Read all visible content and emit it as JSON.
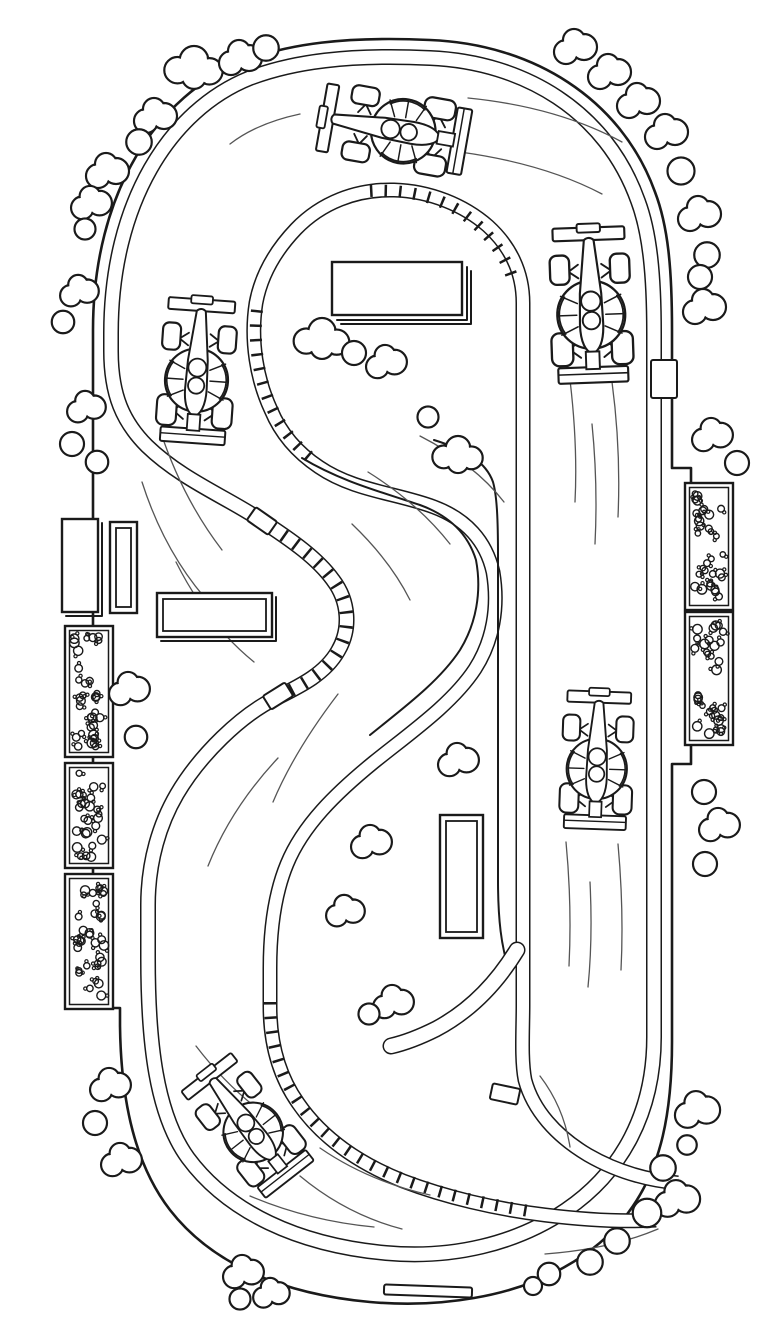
{
  "scene": {
    "kind": "coloring-page line-art illustration",
    "subject": "top-down race track with formula cars",
    "background": "#ffffff",
    "ink": "#1a1a1a",
    "speedline_color": "#555555",
    "width": 768,
    "height": 1344
  },
  "track": {
    "outer_wall": "M 430,40 C 532,44 621,98 655,192 C 668,226 672,268 672,330 L 672,468 L 691,468 L 691,764 L 672,764 L 672,1042 C 672,1110 662,1168 628,1213 C 596,1256 540,1287 474,1298 C 440,1304 404,1305 370,1302 C 282,1294 212,1264 170,1210 C 136,1166 121,1104 120,1026 L 120,1008 L 93,1008 L 93,330 C 93,192 158,94 244,61 C 288,44 345,36 430,40 Z",
    "wall_band": "M 430,58 C 524,62 606,111 638,201 C 650,233 654,276 654,333 L 654,1037 C 654,1112 622,1172 566,1210 C 516,1244 452,1259 386,1253 C 298,1245 228,1212 188,1158 C 156,1114 148,1042 148,958 L 148,905 C 148,861 160,823 177,794 C 200,755 241,715 276,698 C 300,686 325,674 338,651 C 351,629 349,601 333,580 C 318,559 293,541 259,519 C 226,497 181,479 147,446 C 123,422 111,395 111,351 L 111,333 C 111,203 170,110 250,78 C 292,62 348,54 430,58 Z",
    "wall_hairpin_hatch": "M 259,519 C 293,541 318,559 333,580 C 349,601 351,629 338,651 C 325,674 300,686 276,698",
    "island_band": "M 678,1183 C 645,1180 614,1170 588,1155 C 556,1136 533,1110 525,1080 C 521,1060 523,1030 523,1005 L 523,303 C 523,272 510,246 488,226 C 464,205 430,191 394,190 C 356,189 321,203 296,229 C 275,251 261,276 256,303 C 250,341 257,380 271,410 C 281,434 298,453 319,467 C 354,491 397,493 434,507 C 466,519 486,541 493,572 C 499,607 493,641 475,669 C 452,704 410,733 374,762 C 336,793 303,825 287,864 C 275,893 270,929 270,968 L 270,1006 C 270,1043 279,1076 298,1103 C 322,1138 358,1163 403,1181 C 445,1197 495,1209 545,1215 C 586,1220 625,1222 656,1220",
    "island_hatches": [
      "M 370,191 C 404,189 438,196 464,214 C 489,232 507,256 514,284",
      "M 257,310 C 253,344 259,380 272,408 C 282,430 297,448 316,462",
      "M 270,1002 C 270,1042 280,1076 299,1103 C 323,1137 359,1162 403,1179 C 441,1194 486,1204 529,1211"
    ],
    "detail_lines": [
      "M 302,458 C 342,482 382,492 420,505 C 450,516 468,534 476,560 C 482,592 476,624 460,650 C 439,682 402,709 370,735",
      "M 434,440 C 466,450 486,462 493,482 C 497,496 498,520 498,556 L 498,880 C 498,918 501,948 510,972"
    ],
    "pit_ramp": "M 517,950 C 495,986 468,1012 436,1029 C 420,1037 404,1043 391,1046",
    "markers": [
      {
        "x": 262,
        "y": 521,
        "w": 26,
        "h": 16,
        "rot": 35
      },
      {
        "x": 278,
        "y": 696,
        "w": 26,
        "h": 16,
        "rot": -32
      },
      {
        "x": 505,
        "y": 1094,
        "w": 28,
        "h": 16,
        "rot": 12
      },
      {
        "x": 664,
        "y": 379,
        "w": 26,
        "h": 38,
        "rot": 0
      },
      {
        "x": 428,
        "y": 1291,
        "w": 88,
        "h": 10,
        "rot": 2
      }
    ]
  },
  "buildings": [
    {
      "name": "left-building-solid",
      "x": 62,
      "y": 519,
      "w": 36,
      "h": 93,
      "style": "solid3d"
    },
    {
      "name": "left-building-outline",
      "x": 110,
      "y": 522,
      "w": 27,
      "h": 91,
      "style": "inner"
    },
    {
      "name": "infield-building-wide",
      "x": 157,
      "y": 593,
      "w": 115,
      "h": 44,
      "style": "inner3d"
    },
    {
      "name": "top-building",
      "x": 332,
      "y": 262,
      "w": 130,
      "h": 53,
      "style": "shadow"
    },
    {
      "name": "infield-building-small",
      "x": 440,
      "y": 815,
      "w": 43,
      "h": 123,
      "style": "inner"
    }
  ],
  "grandstands": [
    {
      "name": "left-grandstand",
      "x": 65,
      "w": 48,
      "sections": [
        [
          626,
          757
        ],
        [
          763,
          868
        ],
        [
          874,
          1009
        ]
      ],
      "seed": 7
    },
    {
      "name": "right-grandstand",
      "x": 685,
      "w": 48,
      "sections": [
        [
          483,
          610
        ],
        [
          612,
          745
        ]
      ],
      "seed": 13
    }
  ],
  "cars": [
    {
      "name": "car-top",
      "x": 396,
      "y": 130,
      "rot": -80,
      "s": 0.92
    },
    {
      "name": "car-left",
      "x": 197,
      "y": 373,
      "rot": 4,
      "s": 0.9
    },
    {
      "name": "car-right-upper",
      "x": 591,
      "y": 307,
      "rot": -2,
      "s": 0.97
    },
    {
      "name": "car-right-lower",
      "x": 597,
      "y": 762,
      "rot": 2,
      "s": 0.86
    },
    {
      "name": "car-bottom",
      "x": 249,
      "y": 1127,
      "rot": -38,
      "s": 0.85
    }
  ],
  "clouds": [
    [
      194,
      68,
      1.1,
      3
    ],
    [
      240,
      59,
      1.0,
      2
    ],
    [
      266,
      48,
      0.85,
      1
    ],
    [
      155,
      117,
      1.0,
      2
    ],
    [
      139,
      142,
      0.85,
      1
    ],
    [
      107,
      172,
      1.0,
      2
    ],
    [
      91,
      204,
      0.95,
      2
    ],
    [
      85,
      229,
      0.7,
      1
    ],
    [
      79,
      292,
      0.9,
      2
    ],
    [
      63,
      322,
      0.75,
      1
    ],
    [
      86,
      408,
      0.9,
      2
    ],
    [
      72,
      444,
      0.8,
      1
    ],
    [
      97,
      462,
      0.75,
      1
    ],
    [
      129,
      690,
      0.95,
      2
    ],
    [
      136,
      737,
      0.75,
      1
    ],
    [
      110,
      1086,
      0.95,
      2
    ],
    [
      95,
      1123,
      0.8,
      1
    ],
    [
      121,
      1161,
      0.95,
      2
    ],
    [
      243,
      1273,
      0.95,
      2
    ],
    [
      271,
      1294,
      0.85,
      2
    ],
    [
      240,
      1299,
      0.7,
      1
    ],
    [
      697,
      1111,
      1.05,
      2
    ],
    [
      687,
      1145,
      0.65,
      1
    ],
    [
      663,
      1168,
      0.85,
      1
    ],
    [
      677,
      1200,
      1.05,
      2
    ],
    [
      647,
      1213,
      0.95,
      1
    ],
    [
      617,
      1241,
      0.85,
      1
    ],
    [
      590,
      1262,
      0.85,
      1
    ],
    [
      549,
      1274,
      0.75,
      1
    ],
    [
      533,
      1286,
      0.6,
      1
    ],
    [
      575,
      48,
      1.0,
      2
    ],
    [
      609,
      73,
      1.0,
      2
    ],
    [
      638,
      102,
      1.0,
      2
    ],
    [
      666,
      133,
      1.0,
      2
    ],
    [
      681,
      171,
      0.9,
      1
    ],
    [
      699,
      215,
      1.0,
      2
    ],
    [
      707,
      255,
      0.85,
      1
    ],
    [
      700,
      277,
      0.8,
      1
    ],
    [
      704,
      308,
      1.0,
      2
    ],
    [
      712,
      436,
      0.95,
      2
    ],
    [
      737,
      463,
      0.8,
      1
    ],
    [
      704,
      792,
      0.8,
      1
    ],
    [
      719,
      826,
      0.95,
      2
    ],
    [
      705,
      864,
      0.8,
      1
    ],
    [
      322,
      339,
      1.05,
      3
    ],
    [
      354,
      353,
      0.8,
      1
    ],
    [
      386,
      363,
      0.95,
      2
    ],
    [
      428,
      417,
      0.7,
      1
    ],
    [
      458,
      455,
      0.95,
      3
    ],
    [
      458,
      761,
      0.95,
      2
    ],
    [
      371,
      843,
      0.95,
      2
    ],
    [
      345,
      912,
      0.9,
      2
    ],
    [
      393,
      1003,
      0.95,
      2
    ],
    [
      369,
      1014,
      0.7,
      1
    ]
  ],
  "speed_lines": [
    "M 468,98 C 528,104 578,118 622,142",
    "M 460,152 C 518,160 564,174 602,194",
    "M 300,114 C 272,120 248,130 230,144",
    "M 570,380 C 575,422 577,462 575,502",
    "M 612,382 C 618,427 620,472 618,517",
    "M 592,424 C 596,464 597,504 595,544",
    "M 566,842 C 570,884 571,926 569,966",
    "M 618,844 C 622,888 623,930 621,970",
    "M 590,882 C 592,922 591,957 588,987",
    "M 160,430 C 175,476 196,516 222,550",
    "M 142,482 C 158,532 182,574 214,608",
    "M 176,562 C 196,602 222,636 254,662",
    "M 420,436 C 455,454 484,476 504,502",
    "M 368,472 C 400,492 428,516 450,544",
    "M 352,524 C 376,547 396,572 410,600",
    "M 278,758 C 248,790 224,826 208,866",
    "M 338,694 C 312,728 289,764 273,802",
    "M 196,1046 C 222,1080 252,1108 288,1130",
    "M 320,1148 C 352,1170 390,1186 430,1195",
    "M 300,1176 C 330,1201 364,1219 402,1229",
    "M 545,1254 C 585,1251 625,1243 658,1229",
    "M 540,1076 C 556,1097 566,1121 570,1147",
    "M 250,1196 C 290,1213 332,1223 374,1227"
  ]
}
